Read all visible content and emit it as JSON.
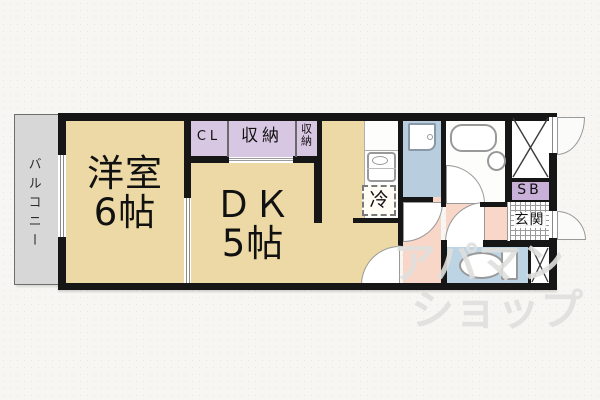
{
  "rooms": {
    "balcony": "バルコニー",
    "western_room": {
      "name": "洋室",
      "size": "6帖"
    },
    "dining_kitchen": {
      "name": "ＤＫ",
      "size": "5帖"
    },
    "closet": "CL",
    "storage_large": "収納",
    "storage_small": "収納",
    "refrigerator": "冷",
    "shoe_box": "SB",
    "entrance": "玄関"
  },
  "watermark": {
    "line1": "アパマン",
    "line2": "ショップ"
  },
  "colors": {
    "room_tan": "#ecd9a5",
    "closet_purple": "#d8c7e2",
    "shoebox_purple": "#c9b0d9",
    "washroom_blue": "#b8cede",
    "toilet_blue": "#bdd4e4",
    "hallway_pink": "#f8d6c8",
    "balcony_gray": "#d7d7d7",
    "wall_black": "#161616",
    "background": "#f7f6f2",
    "watermark_gray": "#dfdfdd"
  }
}
